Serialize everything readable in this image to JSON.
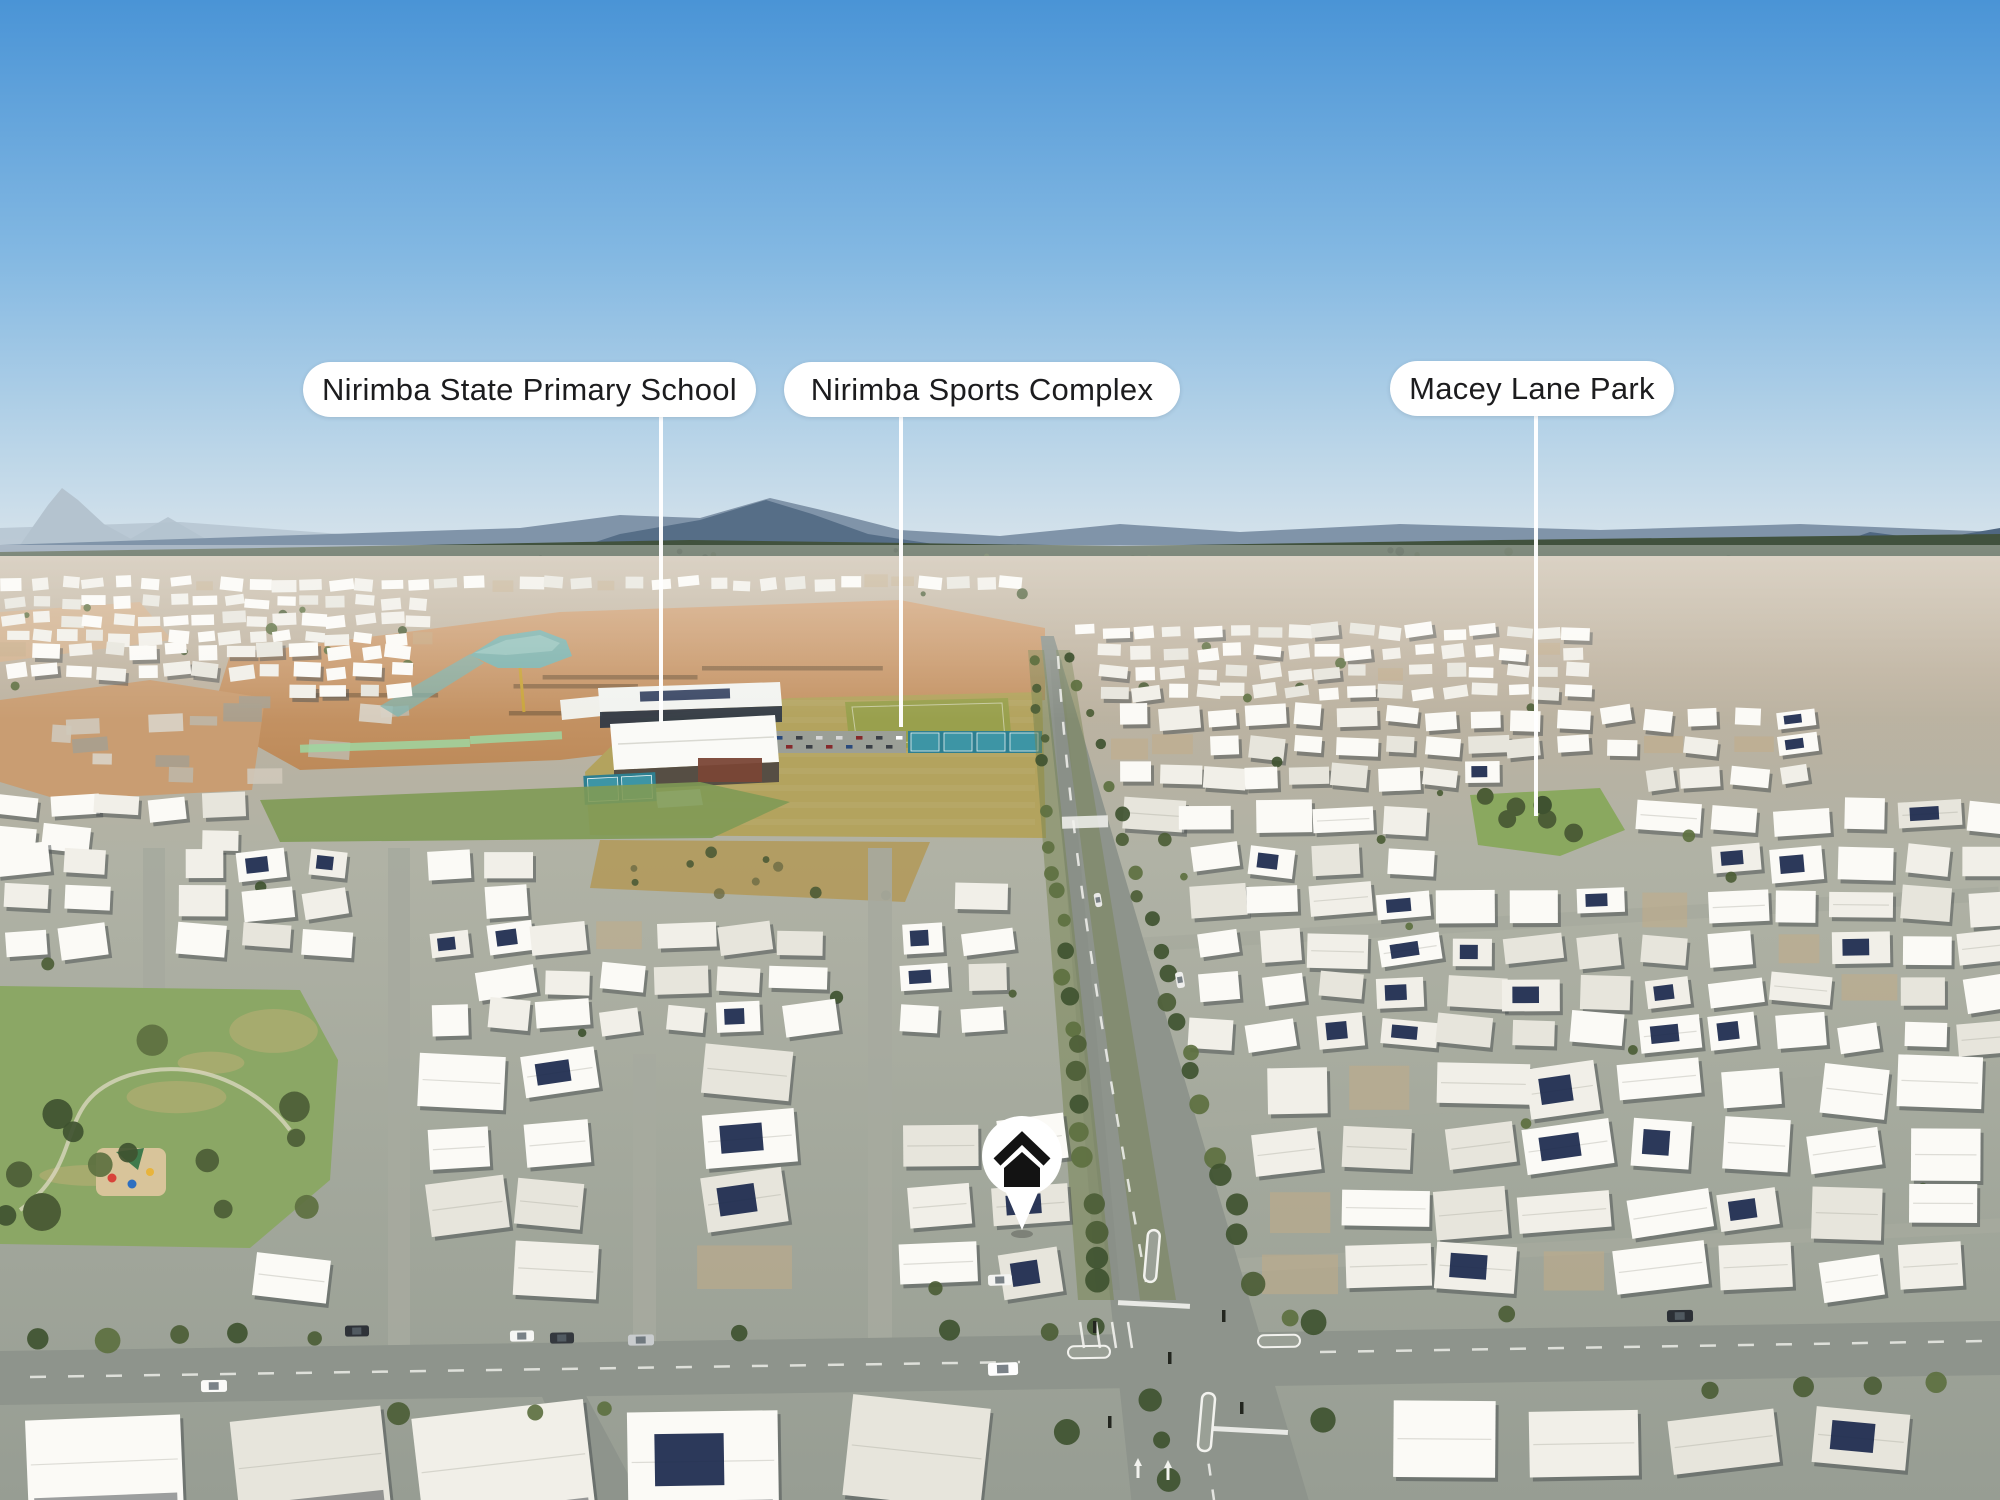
{
  "labels": [
    {
      "text": "Nirimba State Primary School"
    },
    {
      "text": "Nirimba Sports Complex"
    },
    {
      "text": "Macey Lane Park"
    }
  ],
  "marker": {
    "icon": "home-icon"
  },
  "colors": {
    "sky_top": "#4a94d6",
    "sky_mid": "#9cc6e6",
    "sky_horizon": "#dbe5ec",
    "mountain_far": "#b4c3cf",
    "mountain_mid": "#8094a9",
    "mountain_near": "#4f6781",
    "forest": "#41523e",
    "scrub": "#7d7550",
    "dirt": "#c99d72",
    "dirt_deep": "#bb8a5c",
    "field": "#b3a35e",
    "pitch": "#99a04d",
    "court": "#3d95a5",
    "court_dark": "#2e7f90",
    "water": "#7fb3ad",
    "road": "#8e948c",
    "street": "#a6aa9e",
    "roof_bright": "#fbfaf6",
    "roof_mid": "#f1efe8",
    "roof_dim": "#e7e5dc",
    "shadow": "#464b4e",
    "solar": "#1c2a4e",
    "tree_dark": "#3f5230",
    "tree_mid": "#4c5d36",
    "tree_light": "#5d7040",
    "grass_park": "#8ba765",
    "grass_dry": "#c2b077",
    "marking": "#f2f2ee",
    "pill_bg": "#ffffff",
    "pill_text": "#1c1c1e",
    "marker_bg": "#ffffff",
    "marker_glyph": "#131313"
  }
}
